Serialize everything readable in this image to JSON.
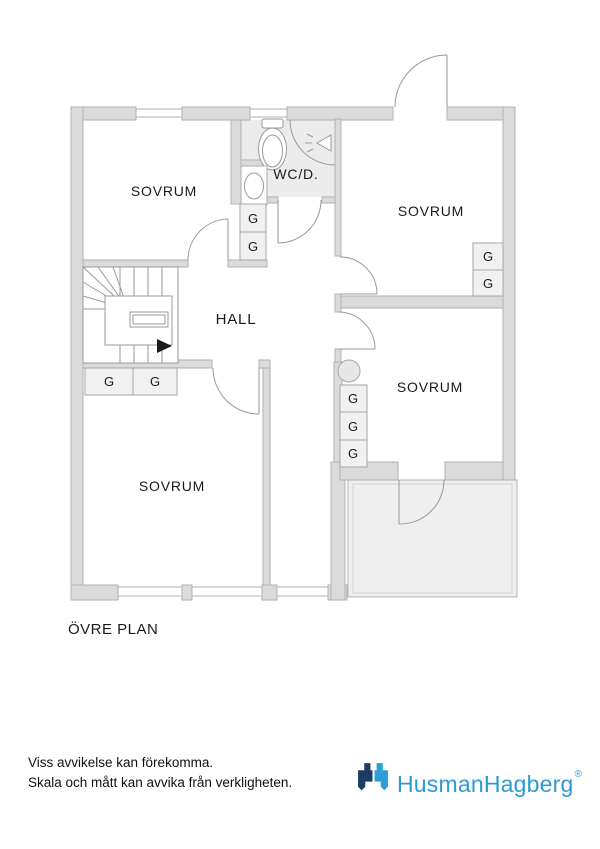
{
  "plan": {
    "title": "ÖVRE PLAN",
    "rooms": [
      {
        "id": "bedroom-top-left",
        "label": "SOVRUM"
      },
      {
        "id": "wc-shower",
        "label": "WC/D."
      },
      {
        "id": "bedroom-top-right",
        "label": "SOVRUM"
      },
      {
        "id": "hall",
        "label": "HALL"
      },
      {
        "id": "bedroom-mid-right",
        "label": "SOVRUM"
      },
      {
        "id": "bedroom-bottom-left",
        "label": "SOVRUM"
      }
    ],
    "closets": [
      {
        "label": "G"
      },
      {
        "label": "G"
      },
      {
        "label": "G"
      },
      {
        "label": "G"
      },
      {
        "label": "G"
      },
      {
        "label": "G"
      },
      {
        "label": "G"
      },
      {
        "label": "G"
      },
      {
        "label": "G"
      }
    ],
    "icons": [
      "toilet-icon",
      "shower-icon",
      "sink-icon",
      "chimney-circle",
      "stairs-direction-arrow"
    ]
  },
  "footer": {
    "disclaimer_line1": "Viss avvikelse kan förekomma.",
    "disclaimer_line2": "Skala och mått kan avvika från verkligheten.",
    "brand_name": "HusmanHagberg",
    "registered_mark": "®"
  },
  "colors": {
    "wall_fill": "#dbdbdb",
    "wall_stroke": "#b1b1b1",
    "thin_line": "#9a9a9a",
    "wet_room_floor": "#ececec",
    "balcony_fill": "#efefef",
    "closet_fill": "#f1f1f1",
    "brand_dark_blue": "#1d3c63",
    "brand_light_blue": "#2d9fd8",
    "brand_text_blue": "#2c9bd2"
  }
}
